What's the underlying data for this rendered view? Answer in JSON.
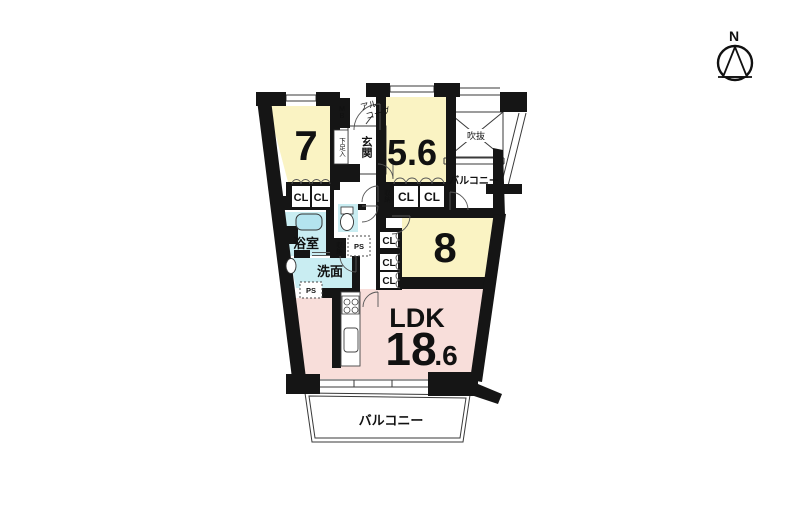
{
  "compass": {
    "north": "N"
  },
  "rooms": {
    "room7": {
      "label": "7"
    },
    "room56": {
      "label": "5.6"
    },
    "room8": {
      "label": "8"
    },
    "ldk": {
      "name": "LDK",
      "area_int": "18",
      "area_frac": ".6"
    }
  },
  "labels": {
    "entrance": "玄関",
    "shoe_cabinet": "下足入",
    "alcove_l1": "アル",
    "alcove_l2": "コーブ",
    "meter_box": "MB",
    "bathroom": "浴室",
    "washroom": "洗面",
    "storage": "収納",
    "closet": "CL",
    "pipe_shaft": "PS",
    "balcony": "バルコニー",
    "atrium": "吹抜"
  },
  "colors": {
    "room_yellow": "#FAF3C3",
    "ldk_pink": "#F8DEDA",
    "wet_cyan": "#C9EDF2",
    "tub_cyan": "#B4E4EF",
    "wall": "#151515"
  }
}
